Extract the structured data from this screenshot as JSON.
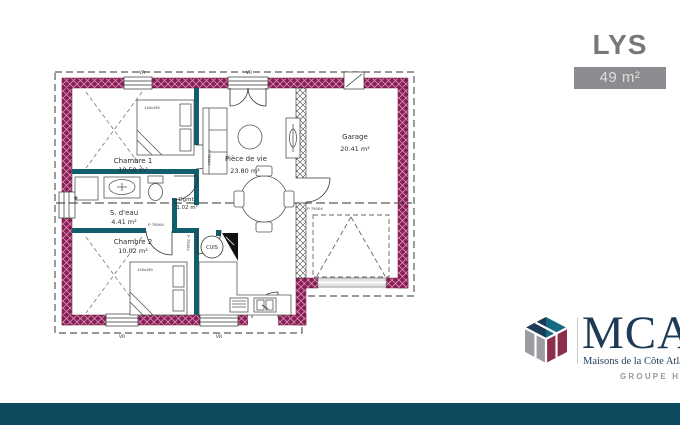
{
  "page": {
    "background": "#ffffff",
    "footer_bar_color": "#0e4a5e"
  },
  "title_block": {
    "model_name": "LYS",
    "area_badge": "49 m²"
  },
  "floor_plan": {
    "colors": {
      "outer_wall": "#8e1c57",
      "partition": "#115e6c",
      "line": "#3c3c3c"
    },
    "rooms": [
      {
        "id": "chambre1",
        "label": "Chambre 1",
        "area": "10.59 m²"
      },
      {
        "id": "s_deau",
        "label": "S. d'eau",
        "area": "4.41 m²"
      },
      {
        "id": "chambre2",
        "label": "Chambre 2",
        "area": "10.02 m²"
      },
      {
        "id": "piece_de_vie",
        "label": "Pièce de vie",
        "area": "23.80 m²"
      },
      {
        "id": "degagement",
        "label": "Dgmt",
        "area": "1.02 m²"
      },
      {
        "id": "cuisine",
        "label": "CUIS"
      },
      {
        "id": "garage",
        "label": "Garage",
        "area": "20.41 m²"
      }
    ],
    "annotations": {
      "roller_shutter": "VR",
      "door_ref": "P 75004",
      "bed_size": "140x190"
    }
  },
  "brand": {
    "acronym": "MCA",
    "tagline": "Maisons de la Côte Atlantique",
    "group": "GROUPE HEXAOM"
  }
}
